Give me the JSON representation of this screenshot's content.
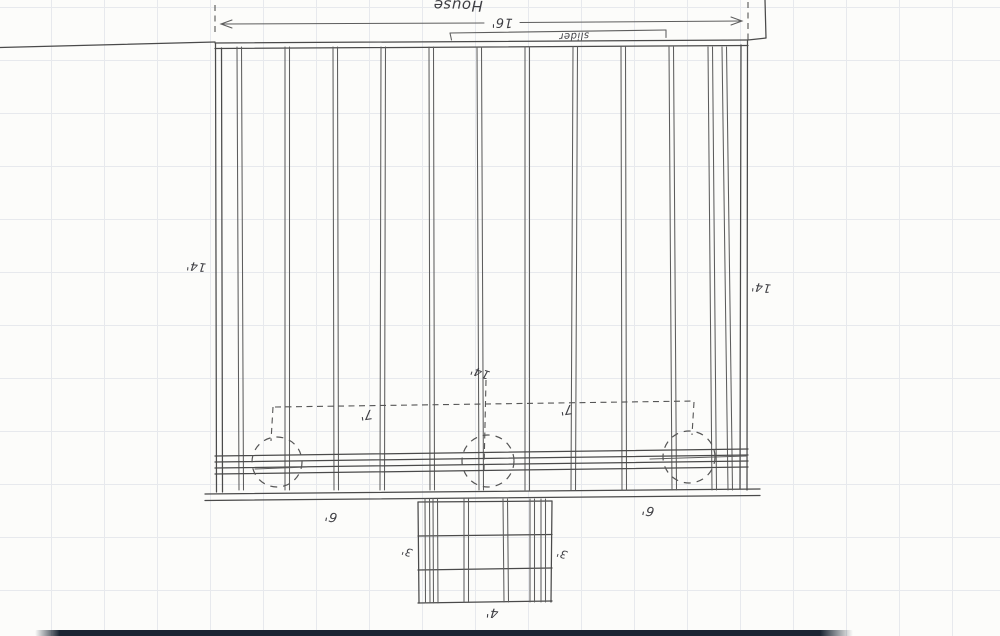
{
  "colors": {
    "ink": "#4a4a4a",
    "paper": "#fcfcfa",
    "grid_line": "#e7e9ed",
    "desk_bar": "#1b2533"
  },
  "labels": {
    "house": "House",
    "overall_width": "16'",
    "slider": "slider",
    "side_depth_left": "14'",
    "side_depth_right": "14'",
    "center_depth": "14'",
    "beam_span_left": "7'",
    "beam_span_right": "7'",
    "beam_offset_left": "6'",
    "beam_offset_right": "6'",
    "stair_depth_left": "3'",
    "stair_depth_right": "3'",
    "stair_width": "4'"
  }
}
